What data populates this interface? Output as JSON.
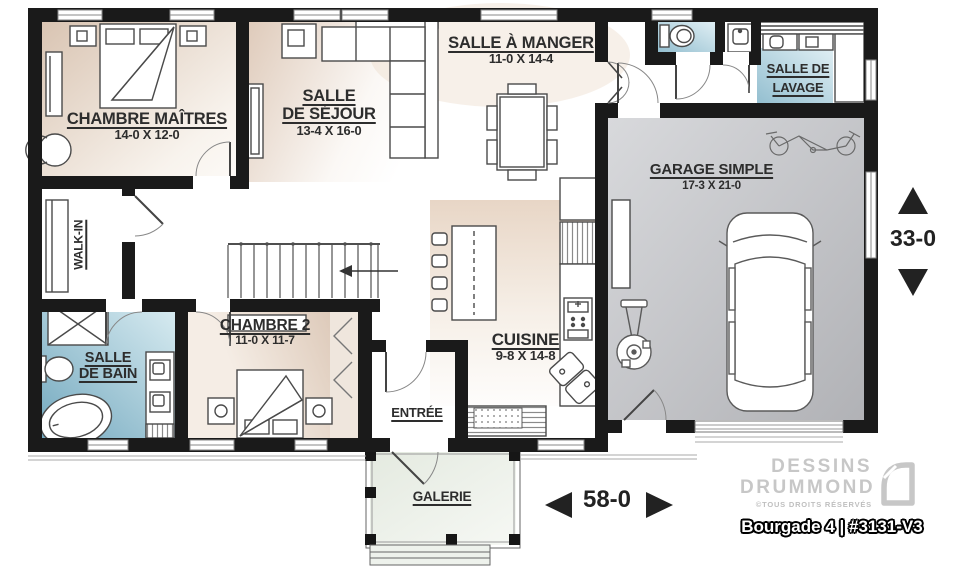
{
  "rooms": {
    "chambre_maitres": {
      "name": "CHAMBRE MAÎTRES",
      "size": "14-0 X 12-0"
    },
    "salle_de_sejour": {
      "name_line1": "SALLE",
      "name_line2": "DE SÉJOUR",
      "size": "13-4 X 16-0"
    },
    "salle_a_manger": {
      "name": "SALLE À MANGER",
      "size": "11-0 X 14-4"
    },
    "salle_de_lavage": {
      "name_line1": "SALLE DE",
      "name_line2": "LAVAGE"
    },
    "garage": {
      "name": "GARAGE SIMPLE",
      "size": "17-3 X 21-0"
    },
    "walk_in": {
      "name": "WALK-IN"
    },
    "chambre_2": {
      "name": "CHAMBRE 2",
      "size": "11-0 X 11-7"
    },
    "salle_de_bain": {
      "name_line1": "SALLE",
      "name_line2": "DE BAIN"
    },
    "cuisine": {
      "name": "CUISINE",
      "size": "9-8 X 14-8"
    },
    "entree": {
      "name": "ENTRÉE"
    },
    "galerie": {
      "name": "GALERIE"
    }
  },
  "dimensions": {
    "overall_width": "58-0",
    "overall_depth": "33-0"
  },
  "branding": {
    "studio_line1": "DESSINS",
    "studio_line2": "DRUMMOND",
    "rights": "©TOUS DROITS RÉSERVÉS",
    "plan_title": "Bourgade 4 | #3131-V3"
  },
  "colors": {
    "wall": "#1a1a1a",
    "room_beige": "#dcc8b7",
    "room_blue": "#7aadc2",
    "room_blue_light": "#9cc4d4",
    "garage_gray": "#b4b5b9",
    "porch_green": "#e6ece2",
    "label_text": "#2d2d2d",
    "logo_gray": "#c7c7c7"
  }
}
